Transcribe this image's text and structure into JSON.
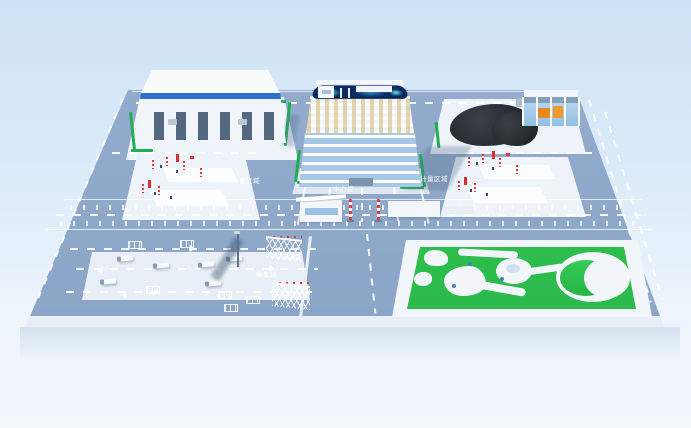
{
  "scene": {
    "type": "3d-site-model",
    "description": "Isometric 3D rendering of an industrial campus: central office tower with rooftop LED screen, unloading warehouse, coal stockpile with shed, two weighbridge pads with red-white marker poles, main gate with barrier pillars, truck parking lot, landscaped garden",
    "labels": {
      "center_building": "中心楼",
      "parking_lot": "停车场",
      "weighbridge_left": "计量区域",
      "weighbridge_right": "计量区域"
    },
    "colors": {
      "sky_top": "#cde2f6",
      "sky_bottom": "#f2f7fc",
      "ground": "#8ea8ca",
      "platform_edge": "#e9eef5",
      "pad_white": "#eef3f9",
      "hedge_green": "#1fae52",
      "lawn_green": "#2cc14e",
      "coal_black": "#26292d",
      "accent_red": "#e23a3a",
      "facade_band_blue": "#2e6fd0",
      "glass_blue": "#8fbce4",
      "screen_navy": "#0a2a60",
      "screen_cyan": "#44d9f2",
      "equipment_orange": "#e8881f"
    }
  }
}
